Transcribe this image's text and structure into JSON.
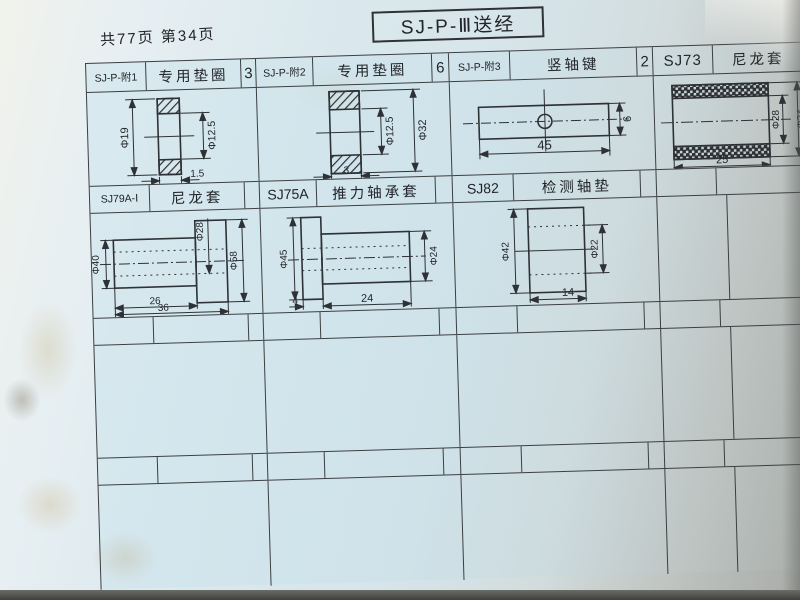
{
  "page": {
    "title": "SJ-P-Ⅲ送经",
    "page_info": "共77页 第34页"
  },
  "parts_table": {
    "row1": {
      "col1": {
        "part_no": "SJ-P-附1",
        "name": "专用垫圈"
      },
      "col2": {
        "qty": "3",
        "part_no": "SJ-P-附2",
        "name": "专用垫圈"
      },
      "col3": {
        "qty": "6",
        "part_no": "SJ-P-附3",
        "name": "竖轴键"
      },
      "col4": {
        "qty": "2",
        "part_no": "SJ73",
        "name": "尼龙套"
      }
    },
    "row2": {
      "col1": {
        "part_no": "SJ79A-Ⅰ",
        "name": "尼龙套"
      },
      "col2": {
        "qty": "",
        "part_no": "SJ75A",
        "name": "推力轴承套"
      },
      "col3": {
        "qty": "",
        "part_no": "SJ82",
        "name": "检测轴垫"
      },
      "col4": {
        "qty": "",
        "part_no": "",
        "name": ""
      }
    }
  },
  "drawings": {
    "special_washer_1": {
      "outer_dia": "Φ19",
      "bore_dia": "Φ12.5",
      "thickness": "1.5"
    },
    "special_washer_2": {
      "bore_dia": "Φ12.5",
      "outer_dia": "Φ32",
      "thickness": "3"
    },
    "vertical_shaft_key": {
      "length": "45",
      "height": "6"
    },
    "nylon_sleeve_sj73": {
      "length": "25",
      "bore_dia": "Φ28",
      "outer_dia": "Φ34"
    },
    "nylon_sleeve_sj79a": {
      "body_dia": "Φ40",
      "bore_dia": "Φ28",
      "flange_dia": "Φ58",
      "body_len": "26",
      "total_len": "36"
    },
    "thrust_bearing_sleeve": {
      "flange_dia": "Φ45",
      "body_dia": "Φ24",
      "flange_width": "4",
      "body_len": "24"
    },
    "detection_shaft_washer": {
      "outer_dia": "Φ42",
      "bore_dia": "Φ22",
      "width": "14"
    }
  }
}
